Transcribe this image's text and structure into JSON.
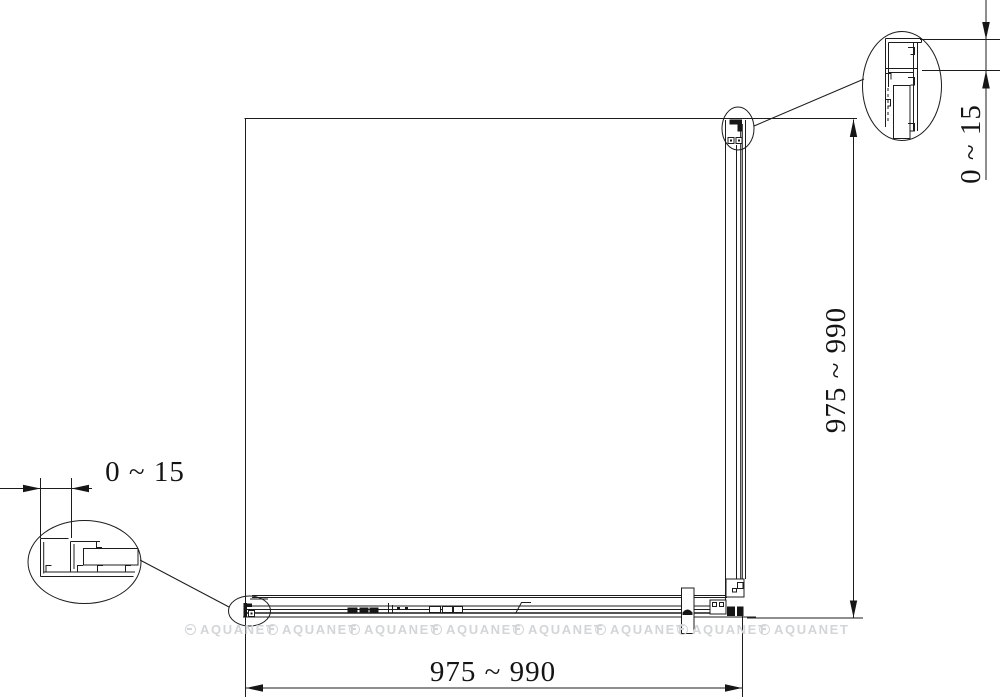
{
  "drawing": {
    "title": "shower-enclosure-plan-drawing",
    "dimensions": {
      "width_bottom": {
        "label": "975 ~ 990"
      },
      "height_right": {
        "label": "975 ~ 990"
      },
      "adjust_bottom_left": {
        "label": "0 ~ 15"
      },
      "adjust_top_right": {
        "label": "0 ~ 15"
      }
    },
    "watermark": {
      "text": "AQUANET",
      "color": "#d3d5d7",
      "count": 8
    },
    "colors": {
      "line": "#1c1c1c",
      "background": "#ffffff"
    }
  }
}
